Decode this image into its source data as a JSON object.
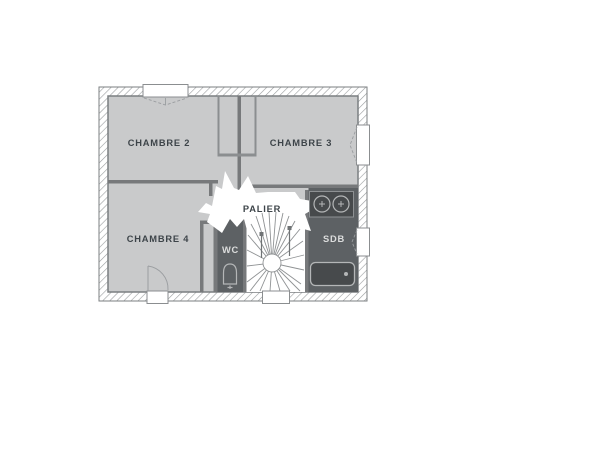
{
  "plan": {
    "title": "floor-plan-etage",
    "rooms": {
      "chambre2": {
        "label": "CHAMBRE 2"
      },
      "chambre3": {
        "label": "CHAMBRE 3"
      },
      "chambre4": {
        "label": "CHAMBRE 4"
      },
      "palier": {
        "label": "PALIER"
      },
      "wc": {
        "label": "WC"
      },
      "sdb": {
        "label": "SDB"
      }
    },
    "fixtures": [
      "staircase-icon",
      "toilet-icon",
      "double-sink-icon",
      "bathtub-icon"
    ],
    "openings": [
      "window-top",
      "window-right-chambre3",
      "window-right-sdb",
      "window-bottom-stairs",
      "door-bottom-chambre4"
    ],
    "colors": {
      "background": "#ffffff",
      "floor": "#c9cacb",
      "wall_line": "#77797b",
      "hatch_line": "#999c9e",
      "dark_room_floor": "#5d6164",
      "fixture_fill": "#474a4c",
      "fixture_outline": "#b4b6b7",
      "label_dark": "#3d4449",
      "label_light": "#dcdddd"
    }
  }
}
